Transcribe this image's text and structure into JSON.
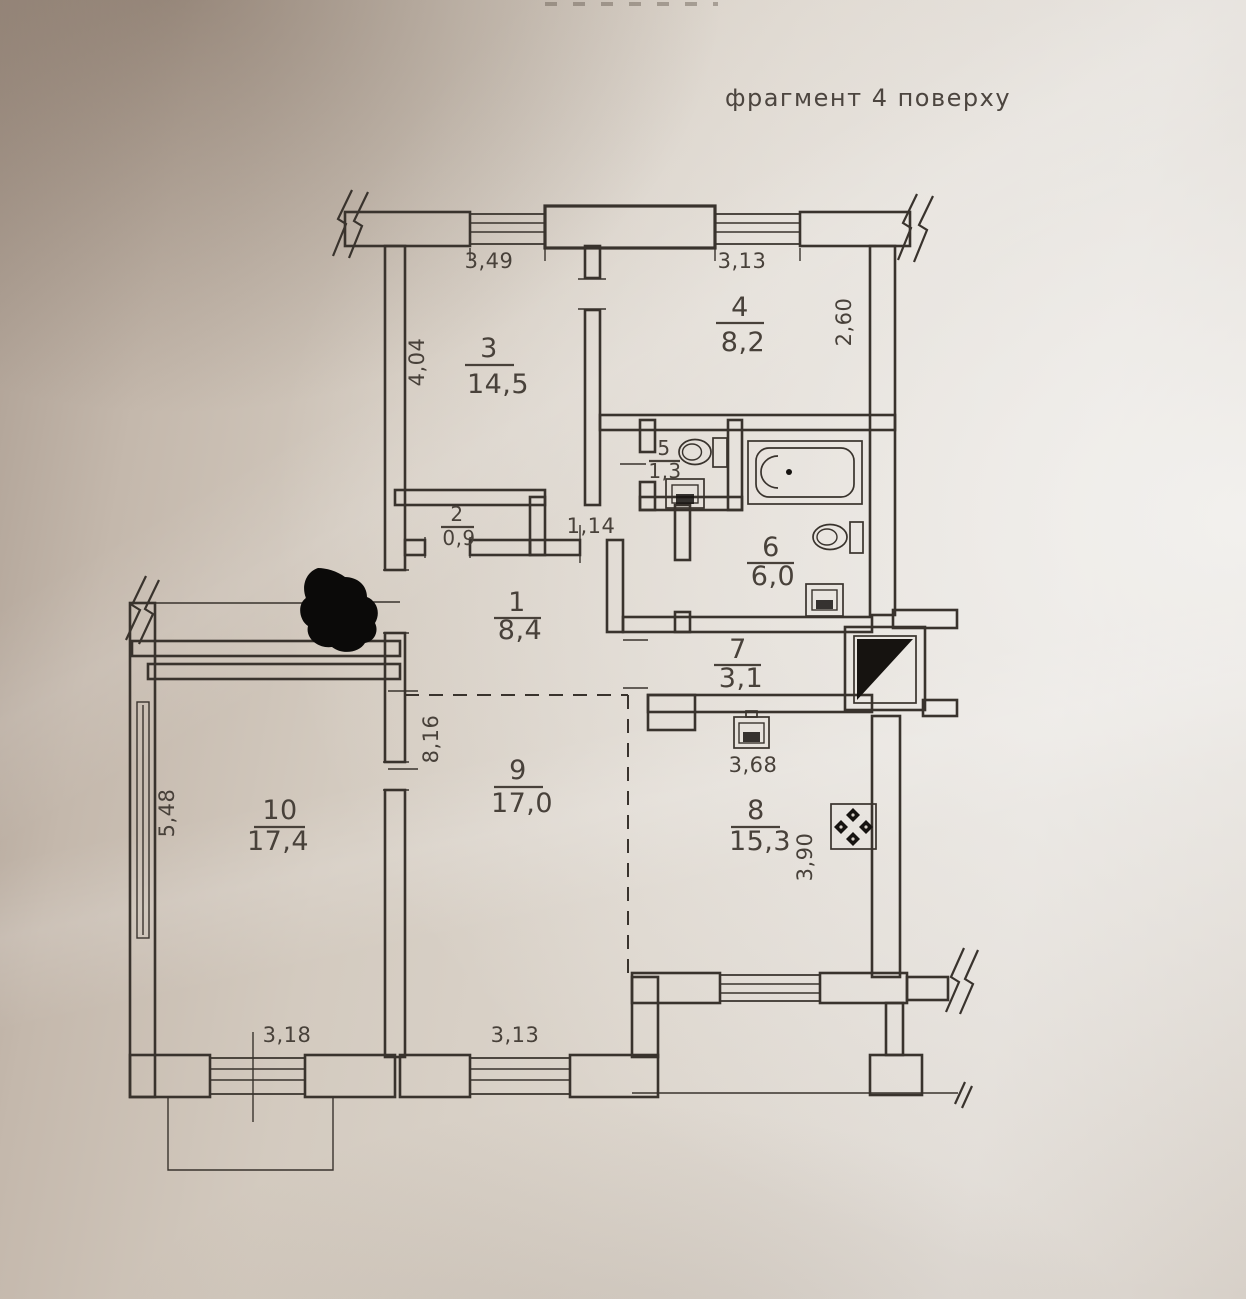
{
  "header": {
    "note": "фрагмент 4 поверху"
  },
  "colors": {
    "ink": "#39332d",
    "text": "#48413a",
    "paper": "#d8d1c9",
    "paper_dark": "#ab9d91",
    "paper_light": "#e1dcd6"
  },
  "rooms": [
    {
      "number": "1",
      "area": "8,4"
    },
    {
      "number": "2",
      "area": "0,9"
    },
    {
      "number": "3",
      "area": "14,5"
    },
    {
      "number": "4",
      "area": "8,2"
    },
    {
      "number": "5",
      "area": "1,3"
    },
    {
      "number": "6",
      "area": "6,0"
    },
    {
      "number": "7",
      "area": "3,1"
    },
    {
      "number": "8",
      "area": "15,3"
    },
    {
      "number": "9",
      "area": "17,0"
    },
    {
      "number": "10",
      "area": "17,4"
    }
  ],
  "dimensions": {
    "room3_width": "3,49",
    "room4_width": "3,13",
    "room3_depth": "4,04",
    "room4_depth": "2,60",
    "hall_passage": "1,14",
    "room9_depth": "8,16",
    "room10_depth": "5,48",
    "room10_width": "3,18",
    "room9_width": "3,13",
    "kitchen_width": "3,68",
    "kitchen_depth": "3,90"
  },
  "fixtures": [
    "bathtub",
    "toilet",
    "sink",
    "stove",
    "vent-shaft"
  ]
}
